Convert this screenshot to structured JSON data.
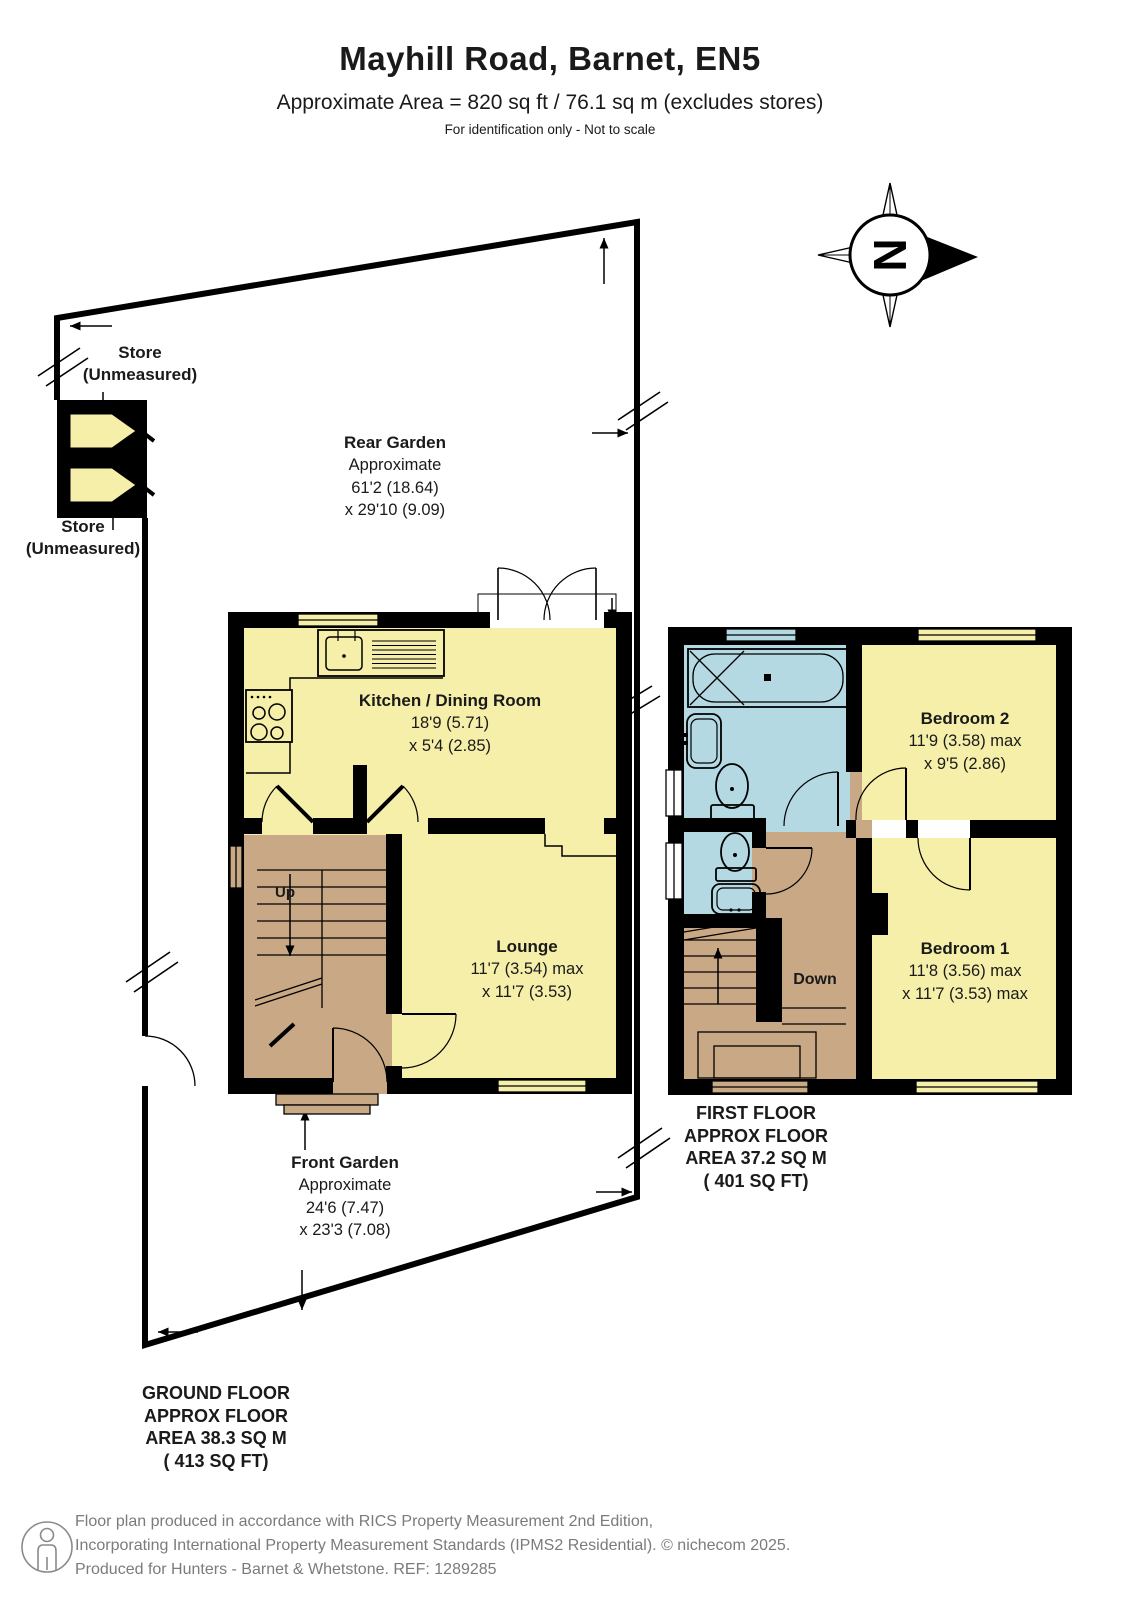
{
  "header": {
    "title": "Mayhill Road, Barnet, EN5",
    "subtitle": "Approximate Area = 820 sq ft / 76.1 sq m (excludes stores)",
    "note": "For identification only - Not to scale"
  },
  "compass": {
    "label": "N"
  },
  "ground_floor": {
    "store_top": "Store\n(Unmeasured)",
    "store_bottom": "Store\n(Unmeasured)",
    "rear_garden": {
      "name": "Rear Garden",
      "dims": "Approximate\n61'2 (18.64)\nx 29'10 (9.09)"
    },
    "kitchen": {
      "name": "Kitchen / Dining Room",
      "dims": "18'9 (5.71)\nx 5'4 (2.85)"
    },
    "lounge": {
      "name": "Lounge",
      "dims": "11'7 (3.54) max\nx 11'7 (3.53)"
    },
    "front_garden": {
      "name": "Front Garden",
      "dims": "Approximate\n24'6 (7.47)\nx 23'3 (7.08)"
    },
    "stairs_label": "Up",
    "floor_label": "GROUND FLOOR\nAPPROX FLOOR\nAREA 38.3 SQ M\n( 413 SQ FT)"
  },
  "first_floor": {
    "bedroom2": {
      "name": "Bedroom 2",
      "dims": "11'9 (3.58) max\nx 9'5 (2.86)"
    },
    "bedroom1": {
      "name": "Bedroom 1",
      "dims": "11'8 (3.56) max\nx 11'7 (3.53) max"
    },
    "stairs_label": "Down",
    "floor_label": "FIRST FLOOR\nAPPROX FLOOR\nAREA 37.2 SQ M\n( 401 SQ FT)"
  },
  "footer": {
    "line1": "Floor plan produced in accordance with RICS Property Measurement 2nd Edition,",
    "line2": "Incorporating International Property Measurement Standards (IPMS2 Residential).   © nichecom 2025.",
    "line3": "Produced for Hunters - Barnet & Whetstone.   REF: 1289285"
  },
  "colors": {
    "room_yellow": "#F5EFA9",
    "hall_tan": "#C9A886",
    "bath_blue": "#B4D9E2",
    "wall": "#000000",
    "footer_text": "#7B7B7B"
  }
}
